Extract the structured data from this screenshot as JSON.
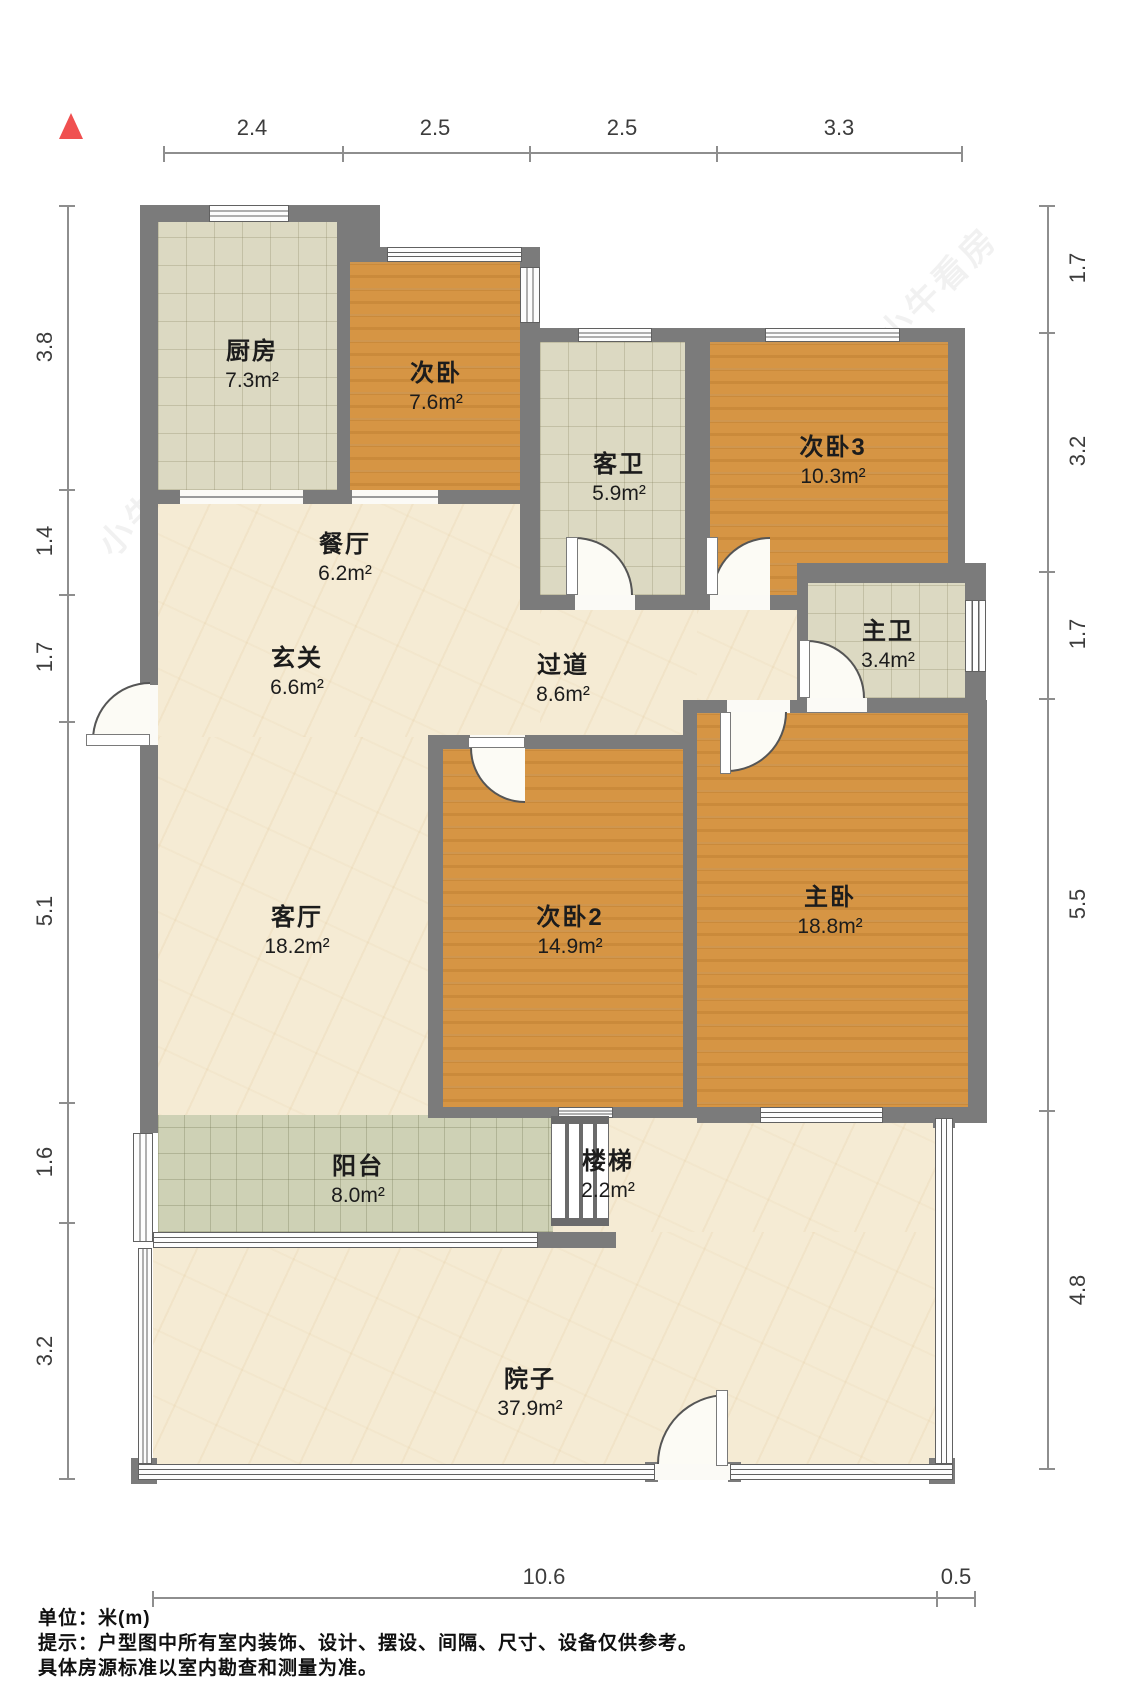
{
  "rooms": [
    {
      "id": "kitchen",
      "name": "厨房",
      "area": "7.3m²"
    },
    {
      "id": "bedroom-top",
      "name": "次卧",
      "area": "7.6m²"
    },
    {
      "id": "guest-bath",
      "name": "客卫",
      "area": "5.9m²"
    },
    {
      "id": "bedroom3",
      "name": "次卧3",
      "area": "10.3m²"
    },
    {
      "id": "dining",
      "name": "餐厅",
      "area": "6.2m²"
    },
    {
      "id": "foyer",
      "name": "玄关",
      "area": "6.6m²"
    },
    {
      "id": "hallway",
      "name": "过道",
      "area": "8.6m²"
    },
    {
      "id": "master-bath",
      "name": "主卫",
      "area": "3.4m²"
    },
    {
      "id": "living",
      "name": "客厅",
      "area": "18.2m²"
    },
    {
      "id": "bedroom2",
      "name": "次卧2",
      "area": "14.9m²"
    },
    {
      "id": "master",
      "name": "主卧",
      "area": "18.8m²"
    },
    {
      "id": "balcony",
      "name": "阳台",
      "area": "8.0m²"
    },
    {
      "id": "stairs",
      "name": "楼梯",
      "area": "2.2m²"
    },
    {
      "id": "yard",
      "name": "院子",
      "area": "37.9m²"
    }
  ],
  "dimensions": {
    "top": [
      "2.4",
      "2.5",
      "2.5",
      "3.3"
    ],
    "left": [
      "3.8",
      "1.4",
      "1.7",
      "5.1",
      "1.6",
      "3.2"
    ],
    "right": [
      "1.7",
      "3.2",
      "1.7",
      "5.5",
      "4.8"
    ],
    "bottom": [
      "10.6",
      "0.5"
    ]
  },
  "notes": {
    "unit": "单位：米(m)",
    "tip1": "提示：户型图中所有室内装饰、设计、摆设、间隔、尺寸、设备仅供参考。",
    "tip2": "具体房源标准以室内勘查和测量为准。"
  },
  "watermark": {
    "text": "小牛看房"
  },
  "compass": {
    "icon": "north-arrow-icon",
    "color": "#f05050"
  },
  "colors": {
    "wall": "#7b7b7b",
    "wood_floor": "#d69544",
    "tile_floor": "#dcd9c2",
    "marble_floor": "#f5ebd4",
    "balcony_floor": "#ced1b5",
    "dimension_line": "#8e8e8e"
  }
}
